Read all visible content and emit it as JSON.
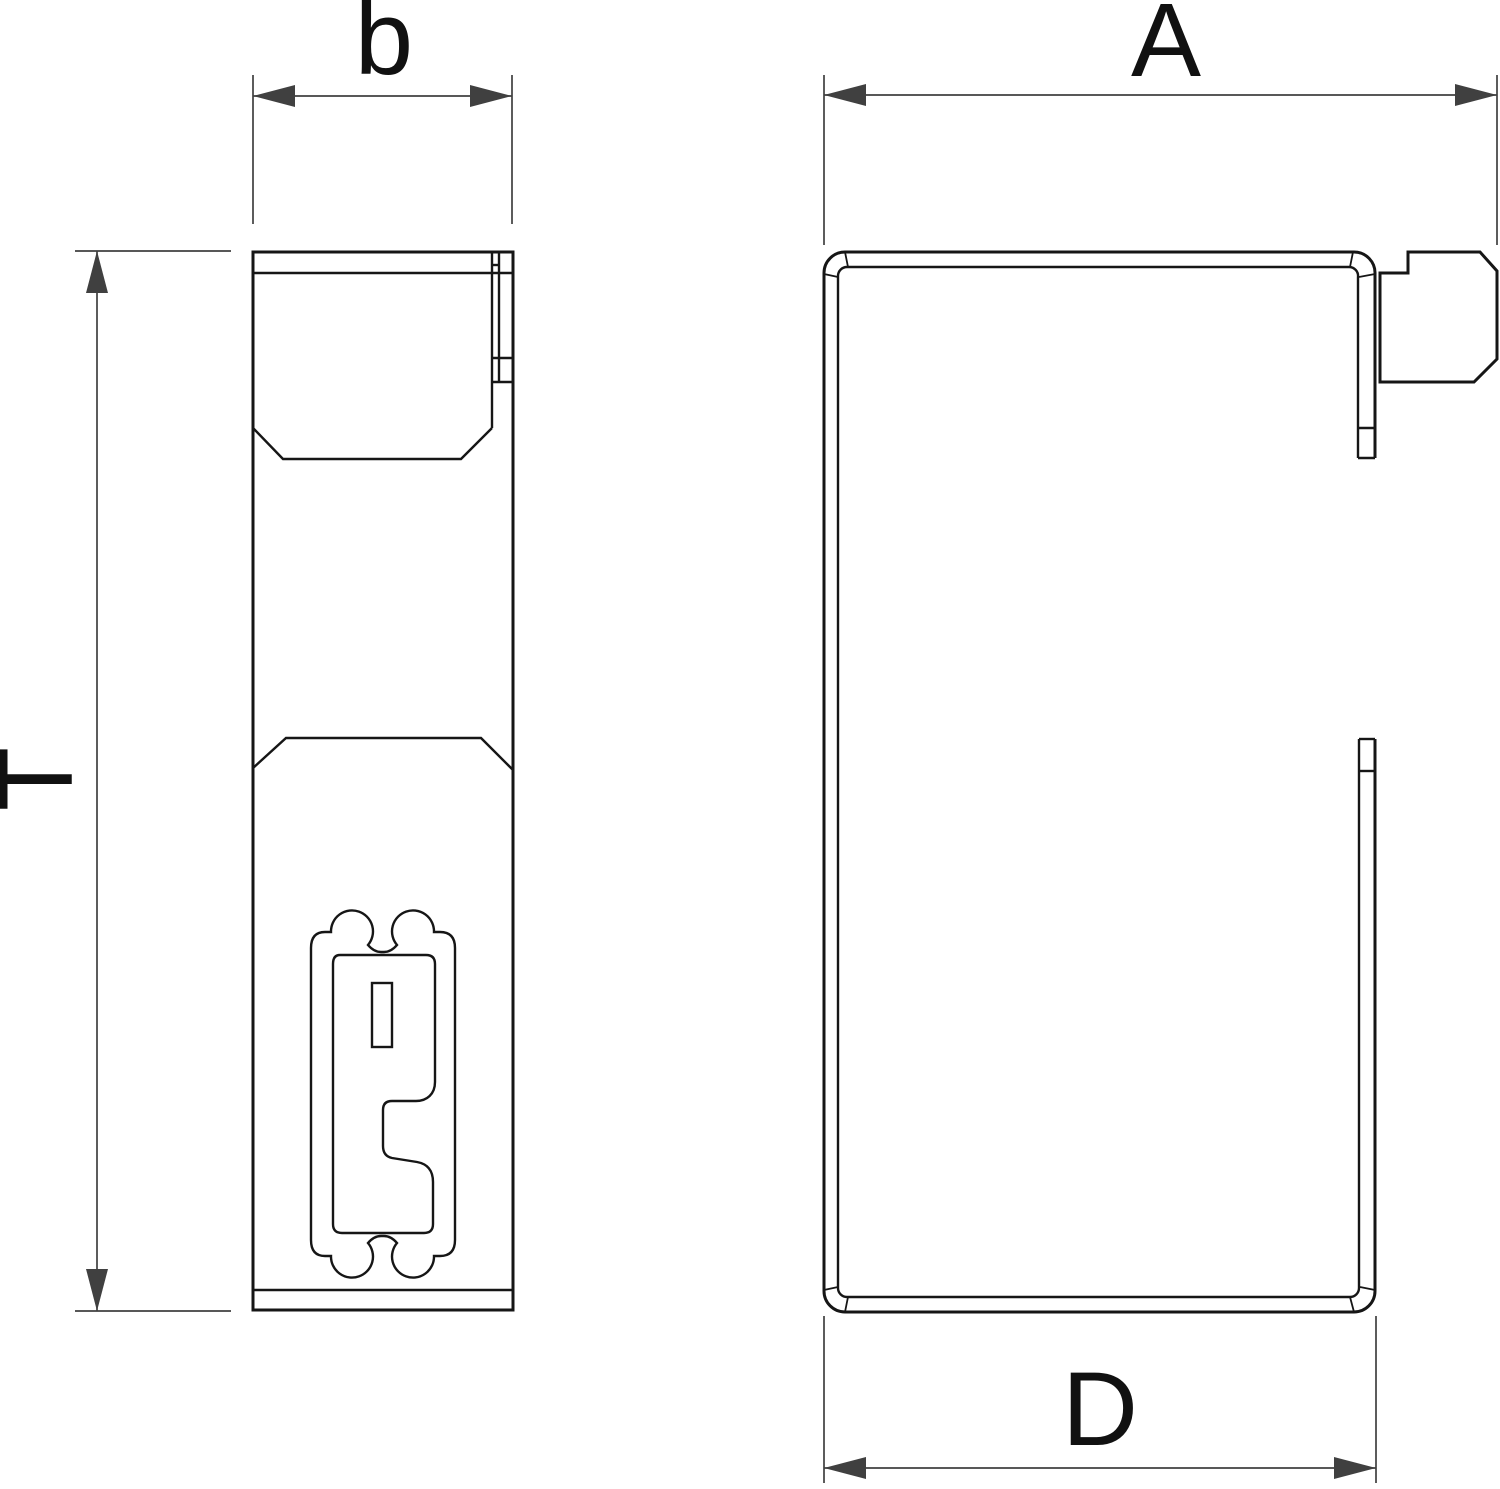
{
  "drawing": {
    "dimension_labels": {
      "top_left": "b",
      "top_right": "A",
      "left": "T",
      "bottom_right": "D"
    },
    "colors": {
      "background": "#ffffff",
      "outline": "#161616",
      "dimension_line": "#404040",
      "label_text": "#111111"
    }
  }
}
